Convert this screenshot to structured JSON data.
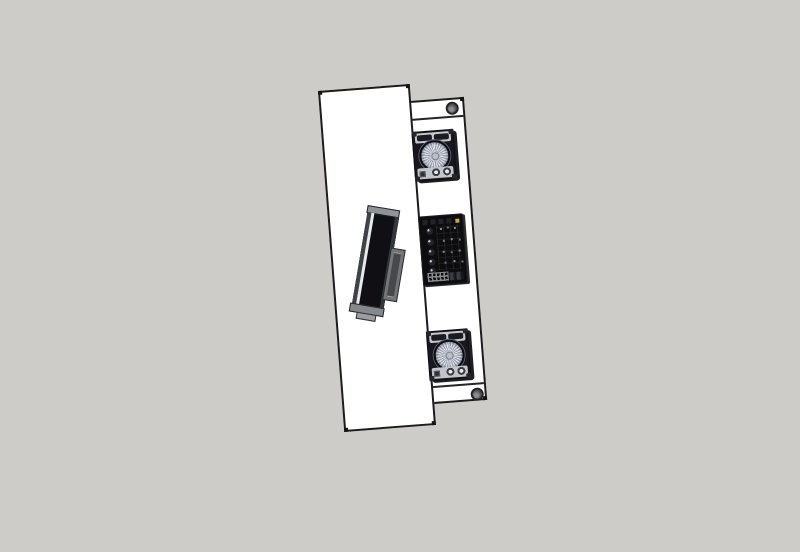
{
  "colors": {
    "bg": "#cdccc9",
    "surface": "#ffffff",
    "edge": "#1c1c1c",
    "band-gray": "#c7c8cc",
    "metal-light": "#dfe2e8",
    "metal-dark": "#979eae",
    "grommet": "#58585a",
    "led-gold": "#c9a83c",
    "monitor-gray": "#8f9398"
  },
  "scene": {
    "view": "top-down orthographic 3D viewport, model rotated slightly counter-clockwise",
    "objects": [
      {
        "id": "desk-surface-panel",
        "kind": "white desk surface"
      },
      {
        "id": "rear-shelf-panel",
        "kind": "white rear shelf strip with end caps"
      },
      {
        "id": "monitor",
        "kind": "flat-screen monitor on stand, rotated on desk"
      },
      {
        "id": "speaker-top",
        "kind": "studio monitor speaker, woofer facing up"
      },
      {
        "id": "mixer-unit",
        "kind": "black rack mixer with knobs and gold LED"
      },
      {
        "id": "speaker-bottom",
        "kind": "studio monitor speaker, woofer facing up"
      },
      {
        "id": "cable-grommet-top",
        "kind": "round desk cable grommet"
      },
      {
        "id": "cable-grommet-bottom",
        "kind": "round desk cable grommet"
      }
    ]
  }
}
